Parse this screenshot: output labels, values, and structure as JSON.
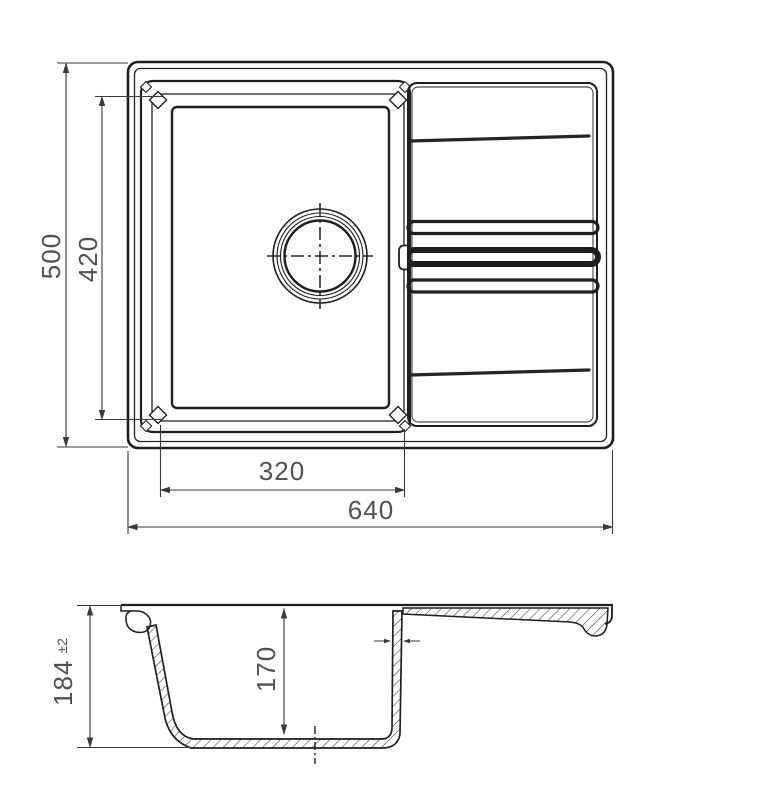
{
  "drawing": {
    "type": "technical-drawing-kitchen-sink",
    "colors": {
      "background": "#ffffff",
      "line": "#1f1f1f",
      "groove": "#262626",
      "dim_line": "#3a3a3a",
      "dim_text": "#515151"
    },
    "dimensions": {
      "overall_width": "640",
      "overall_depth": "500",
      "bowl_width": "320",
      "bowl_length": "420",
      "overall_height": "184",
      "height_tolerance": "±2",
      "bowl_inner_depth": "170"
    }
  }
}
